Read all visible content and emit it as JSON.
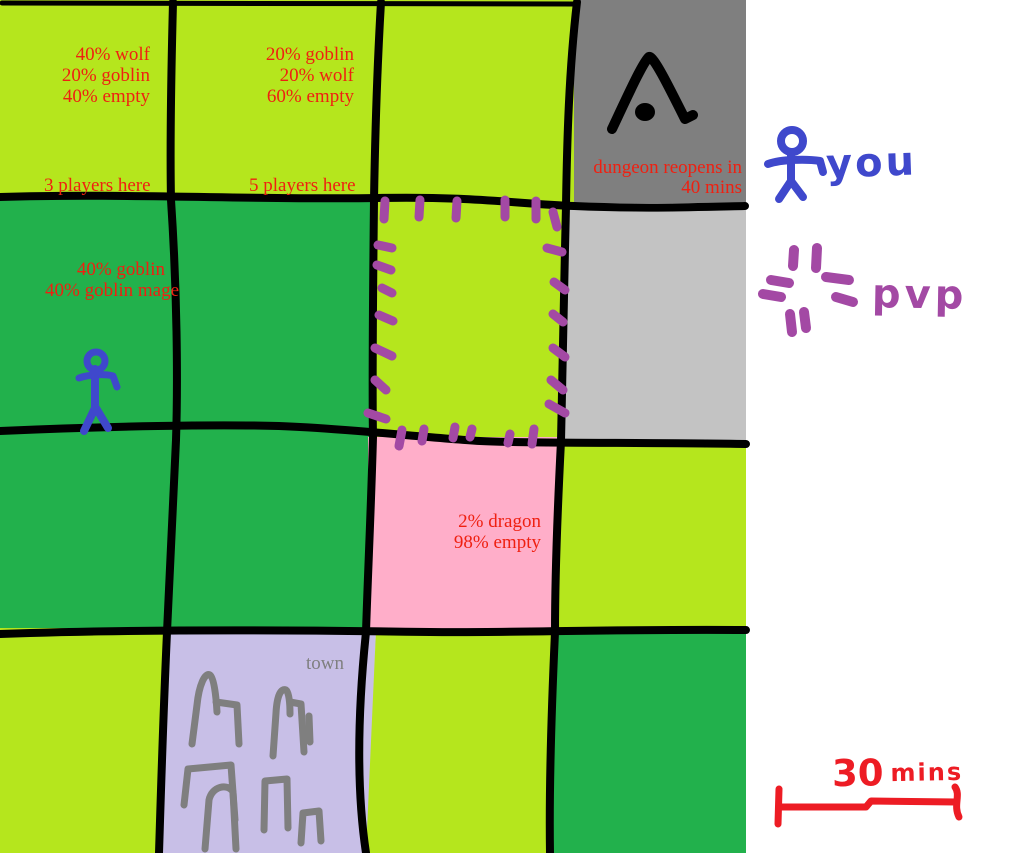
{
  "map": {
    "zones": {
      "northwest": {
        "stat1": "40% wolf",
        "stat2": "20% goblin",
        "stat3": "40% empty",
        "players": "3 players here"
      },
      "north": {
        "stat1": "20% goblin",
        "stat2": "20% wolf",
        "stat3": "60% empty",
        "players": "5 players here"
      },
      "dungeon": {
        "status1": "dungeon reopens in",
        "status2": "40 mins"
      },
      "west": {
        "stat1": "40% goblin",
        "stat2": "40% goblin mage"
      },
      "dragon": {
        "stat1": "2% dragon",
        "stat2": "98% empty"
      },
      "town": {
        "label": "town"
      }
    }
  },
  "legend": {
    "you_label": "you",
    "pvp_label": "pvp",
    "scale_value": "30",
    "scale_unit": "mins"
  },
  "icons": {
    "you": "blue stick-figure",
    "pvp": "purple dashed-border marks",
    "dungeon": "black cave-entrance triangle",
    "town": "gray building outlines",
    "scale": "red scale bar"
  },
  "colors": {
    "grass_light": "#B5E61D",
    "grass_dark": "#22B14C",
    "dungeon_gray": "#7F7F7F",
    "closed_gray": "#C3C3C3",
    "dragon_pink": "#FFAEC9",
    "town_lavender": "#C8BFE7",
    "pvp_purple": "#A349A4",
    "player_blue": "#3F48CC",
    "text_red": "#EF2011",
    "marker_red": "#ED1C24",
    "drawing_gray": "#7F7F7F",
    "line_black": "#000000"
  }
}
